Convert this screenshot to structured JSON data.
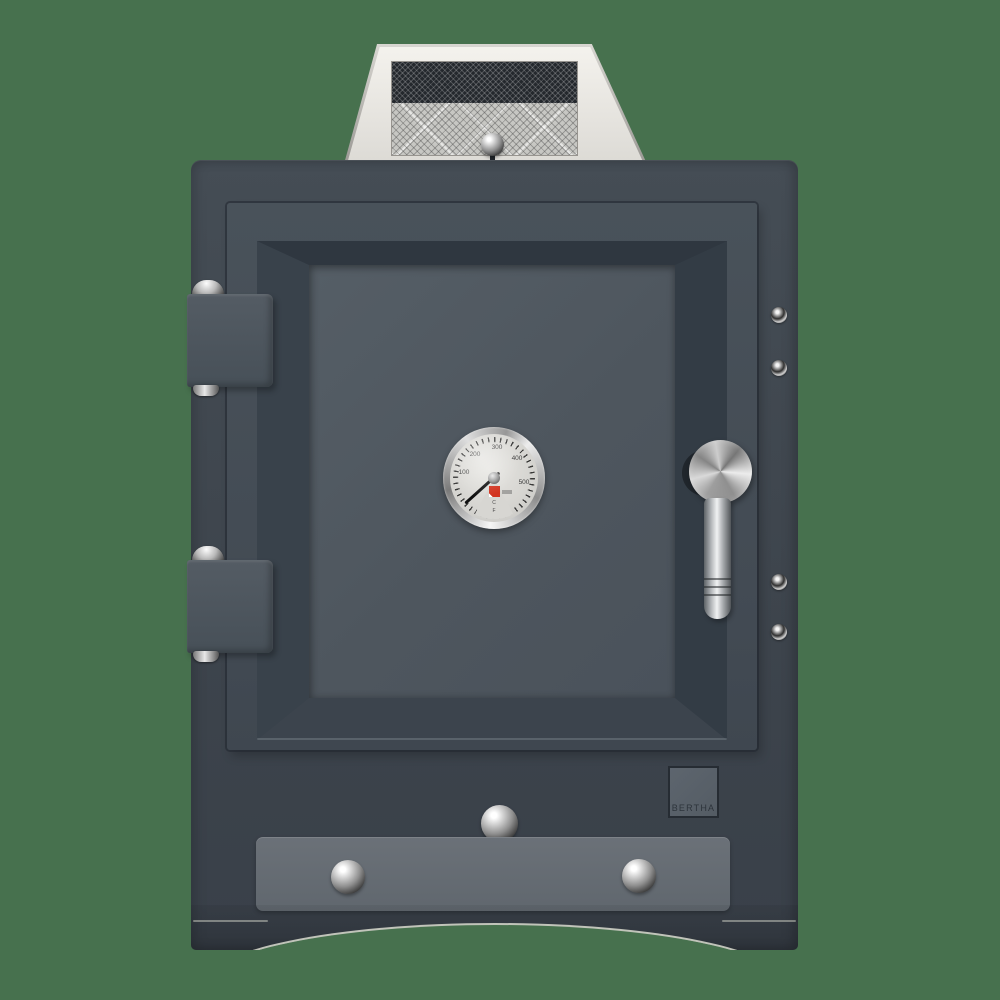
{
  "scene": {
    "background_color": "#47714e"
  },
  "badge": {
    "label": "BERTHA",
    "bg_color": "#59616a",
    "border_color": "#262c33",
    "text_color": "#2d343b"
  },
  "thermometer": {
    "dial_labels": [
      "100",
      "200",
      "300",
      "400",
      "500"
    ],
    "unit_labels": [
      "C",
      "F"
    ],
    "logo_color": "#d23420",
    "face_color": "#d7d6d2",
    "needle_angle_deg": 228
  },
  "colors": {
    "body": "#3f4750",
    "door_face": "#475058",
    "door_panel": "#4f5860",
    "hinge": "#4c545c",
    "drawer": "#656c73",
    "chimney_face": "#eceae5",
    "mesh_dark": "#24282d",
    "mesh_light": "#c7c7c3",
    "chrome_light": "#f2f2f2",
    "chrome_dark": "#1e1e1e"
  }
}
